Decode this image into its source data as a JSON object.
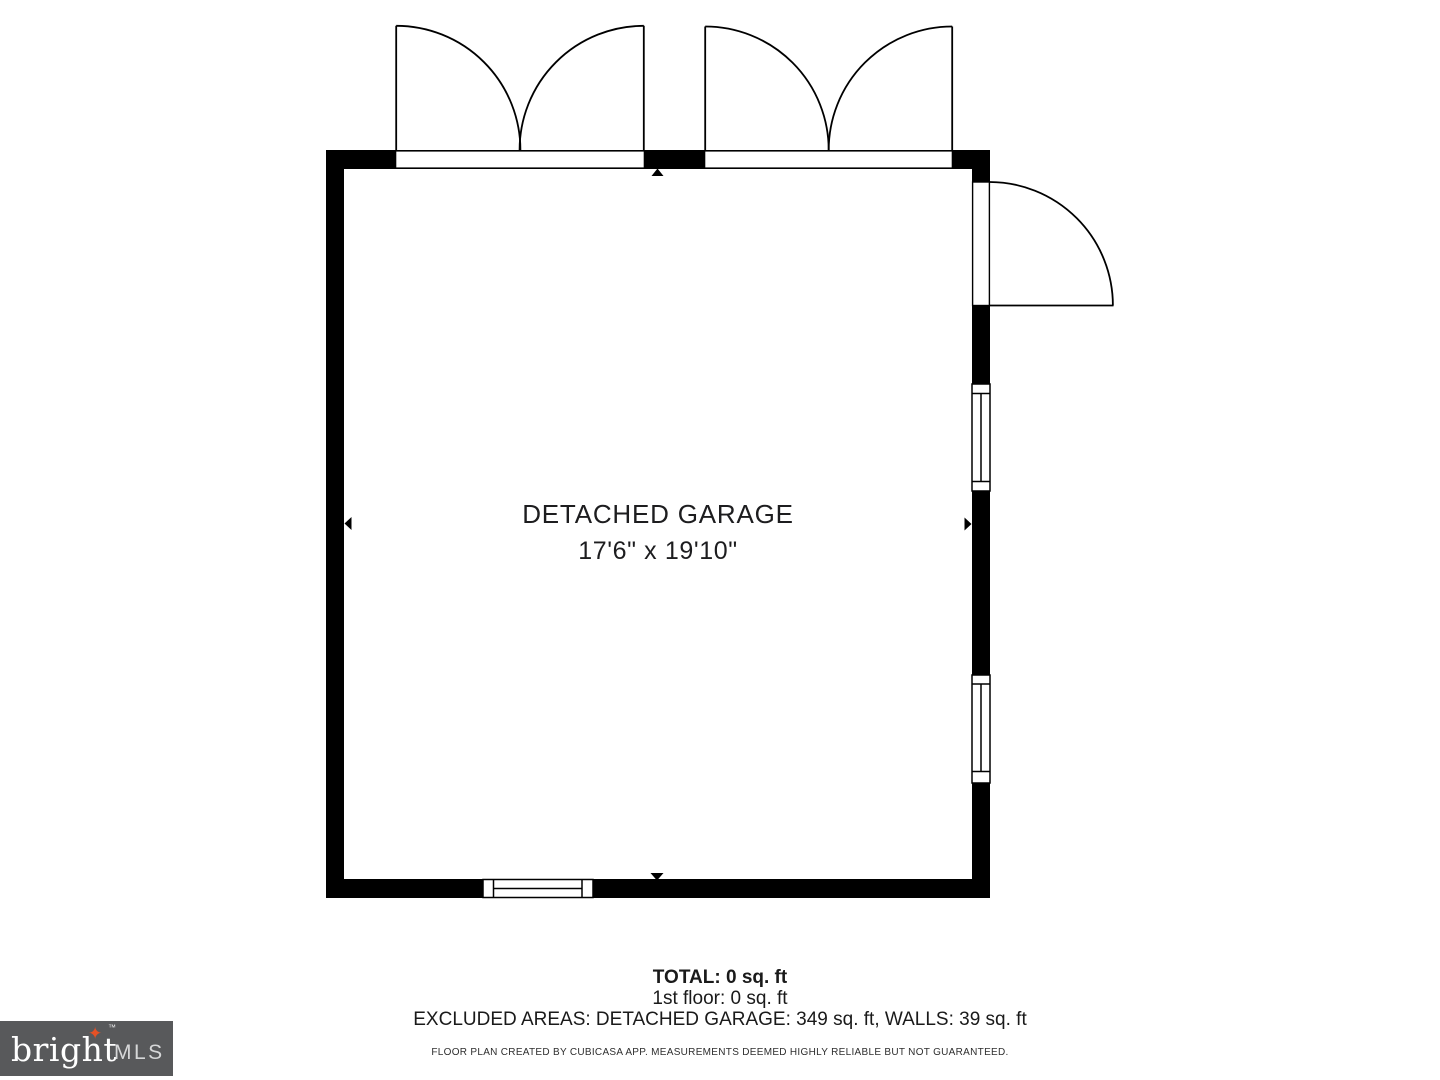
{
  "floorplan": {
    "room": {
      "name": "DETACHED GARAGE",
      "dimensions": "17'6\" x 19'10\""
    },
    "features": {
      "garage_door_1": "double-swing-garage-door",
      "garage_door_2": "double-swing-garage-door",
      "entry_door": "single-swing-door-right-wall",
      "window_right_1": "window",
      "window_right_2": "window",
      "window_bottom": "window",
      "markers": [
        "wall-marker-up",
        "wall-marker-down",
        "wall-marker-left",
        "wall-marker-right"
      ]
    }
  },
  "summary": {
    "total": "TOTAL: 0 sq. ft",
    "first_floor": "1st floor: 0 sq. ft",
    "excluded": "EXCLUDED AREAS: DETACHED GARAGE: 349 sq. ft, WALLS: 39 sq. ft",
    "disclaimer": "FLOOR PLAN CREATED BY CUBICASA APP. MEASUREMENTS DEEMED HIGHLY RELIABLE BUT NOT GUARANTEED."
  },
  "logo": {
    "brand": "bright",
    "star": "✦",
    "trademark": "™",
    "suffix": "MLS",
    "box_color": "#58595b",
    "star_color": "#e65125",
    "brand_color": "#ffffff",
    "suffix_color": "#d6d7d8"
  },
  "colors": {
    "wall": "#000000",
    "background": "#ffffff",
    "text": "#1d1d1f"
  }
}
